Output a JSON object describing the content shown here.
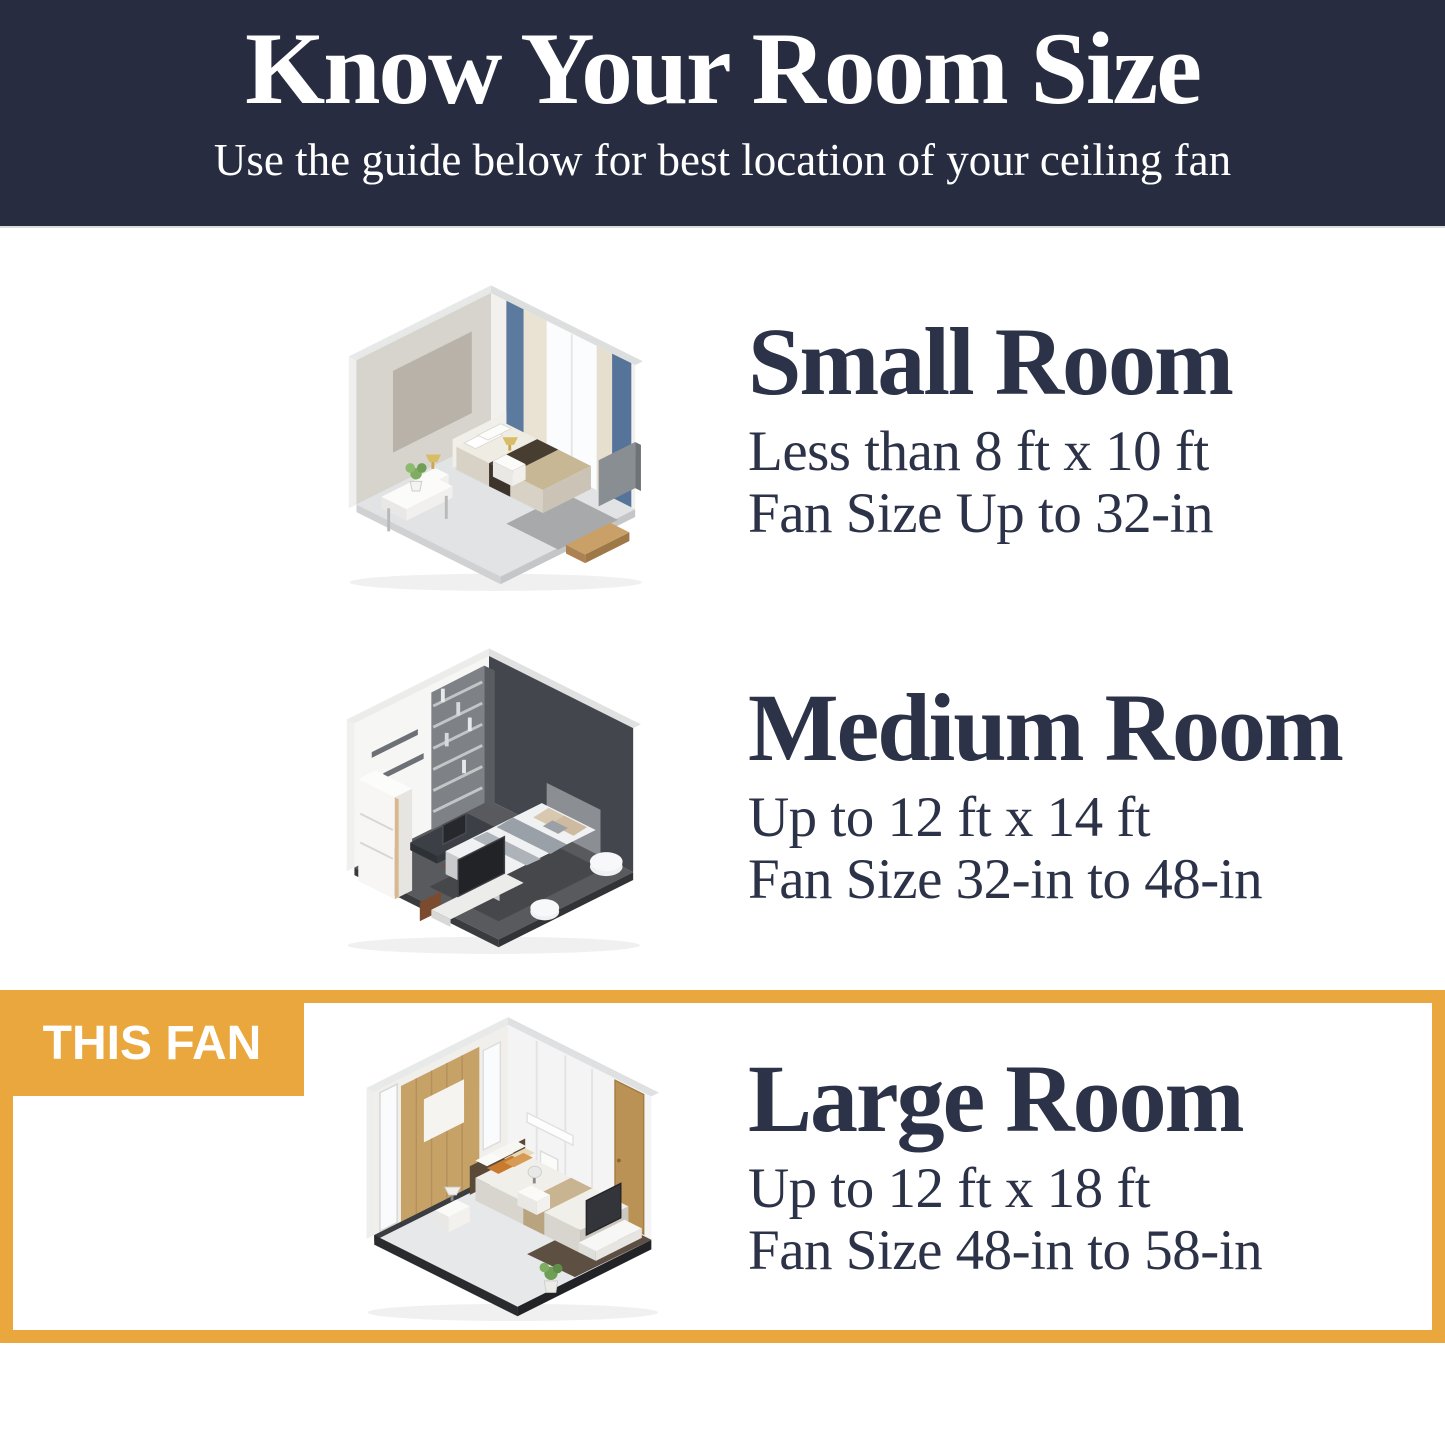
{
  "theme": {
    "header_bg": "#272c40",
    "header_text": "#ffffff",
    "heading_color": "#2c3247",
    "accent_gold": "#eaa73e",
    "page_bg": "#ffffff",
    "badge_text": "#ffffff"
  },
  "header": {
    "title": "Know Your Room Size",
    "subtitle": "Use the guide below for best location of your ceiling fan"
  },
  "sections": [
    {
      "heading": "Small Room",
      "size_range": "Less than 8 ft x 10 ft",
      "fan_size": "Fan Size Up to 32-in",
      "illustration": "small-room-isometric-bedroom"
    },
    {
      "heading": "Medium Room",
      "size_range": "Up to 12 ft x 14 ft",
      "fan_size": "Fan Size 32-in to 48-in",
      "illustration": "medium-room-isometric-bedroom"
    },
    {
      "heading": "Large Room",
      "size_range": "Up to 12 ft x 18 ft",
      "fan_size": "Fan Size 48-in to 58-in",
      "illustration": "large-room-isometric-bedroom",
      "badge": "THIS FAN",
      "highlighted": true
    }
  ]
}
